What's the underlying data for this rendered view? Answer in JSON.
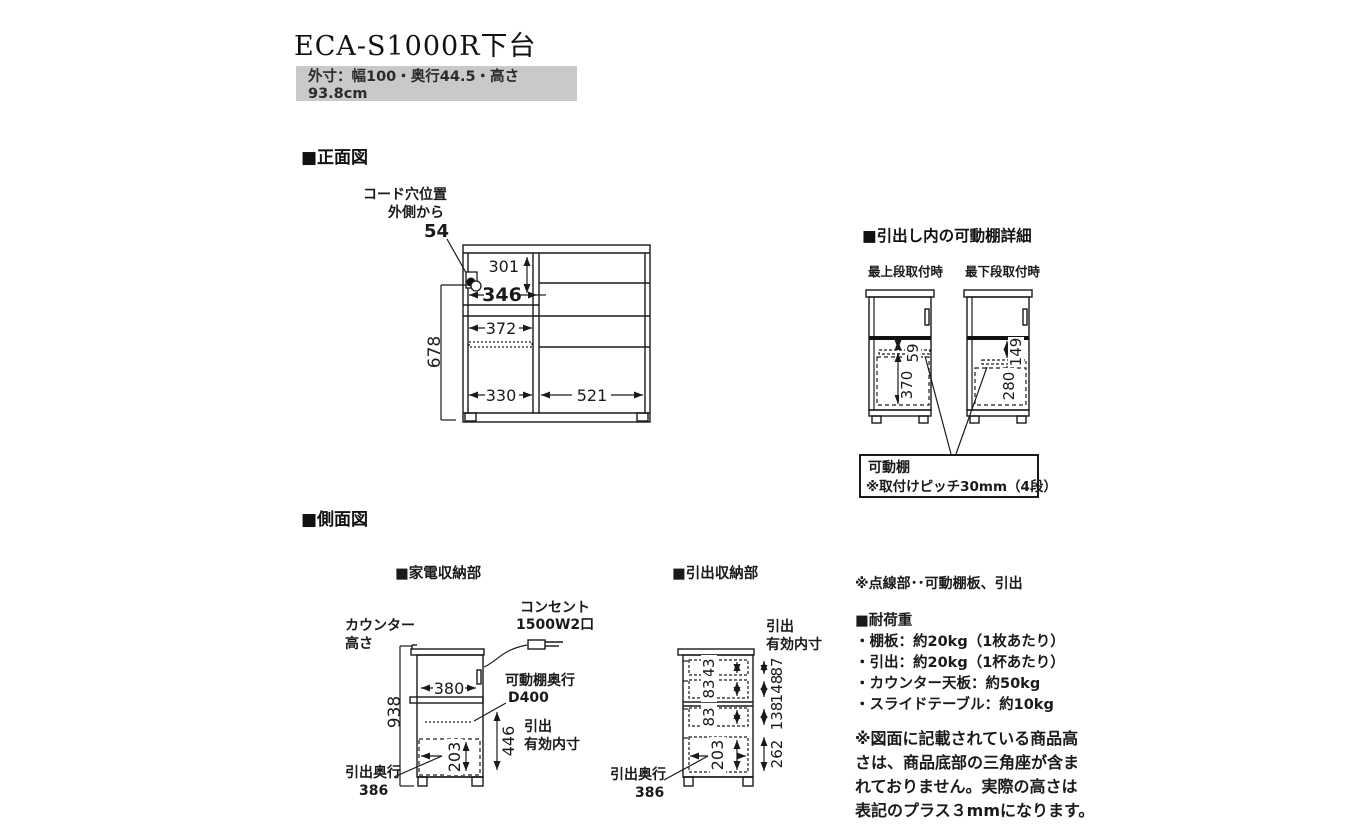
{
  "title": "ECA-S1000R下台",
  "subtitle": "外寸：幅100・奥行44.5・高さ93.8cm",
  "front": {
    "header": "■正面図",
    "cord1": "コード穴位置",
    "cord2": "外側から",
    "cord_val": "54",
    "d301": "301",
    "d346": "346",
    "d372": "372",
    "d678": "678",
    "d330": "330",
    "d521": "521"
  },
  "detail": {
    "header": "■引出し内の可動棚詳細",
    "cap_top": "最上段取付時",
    "cap_bottom": "最下段取付時",
    "d59": "59",
    "d370": "370",
    "d149": "149",
    "d280": "280",
    "box1": "可動棚",
    "box2": "※取付けピッチ30mm（4段）"
  },
  "side": {
    "header": "■側面図",
    "appliance": {
      "header": "■家電収納部",
      "counter1": "カウンター",
      "counter2": "高さ",
      "outlet1": "コンセント",
      "outlet2": "1500W2口",
      "shelf1": "可動棚奥行",
      "shelf2": "D400",
      "inner1": "引出",
      "inner2": "有効内寸",
      "depth1": "引出奥行",
      "depth2": "386",
      "d938": "938",
      "d380": "380",
      "d446": "446",
      "d203": "203"
    },
    "drawer": {
      "header": "■引出収納部",
      "inner1": "引出",
      "inner2": "有効内寸",
      "depth1": "引出奥行",
      "depth2": "386",
      "d43": "43",
      "d83a": "83",
      "d83b": "83",
      "d203": "203",
      "d87": "87",
      "d148": "148",
      "d138": "138",
      "d262": "262"
    }
  },
  "notes": {
    "dotted": "※点線部･･可動棚板、引出",
    "load_header": "■耐荷重",
    "load_items": [
      "・棚板：約20kg（1枚あたり）",
      "・引出：約20kg（1杯あたり）",
      "・カウンター天板：約50kg",
      "・スライドテーブル：約10kg"
    ],
    "height_note": [
      "※図面に記載されている商品高",
      "さは、商品底部の三角座が含ま",
      "れておりません。実際の高さは",
      "表記のプラス３mmになります。"
    ]
  },
  "colors": {
    "ink": "#1a1a1a",
    "banner_bg": "#c9c9c9"
  }
}
